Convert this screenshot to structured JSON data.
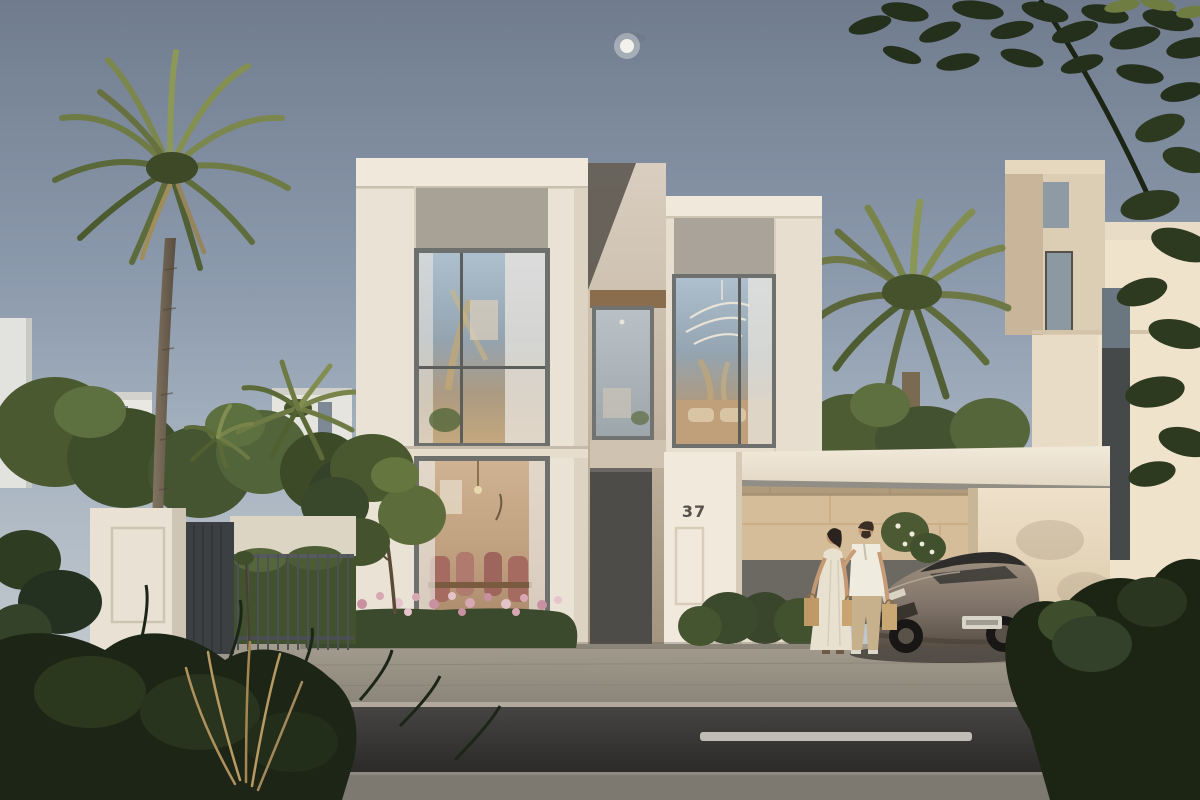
{
  "scene": {
    "title": "Modern villa exterior rendering at dusk",
    "description": "Photorealistic render of a two-storey cream villa with a carport canopy, a bronze sports car, a couple carrying shopping bags, date palms, hedges with pink flowers, a boundary wall with metal gate, and a street in the foreground",
    "house_number": "37",
    "time_of_day": "dusk",
    "objects": [
      "main villa",
      "carport canopy",
      "sports car",
      "couple with shopping bags",
      "date palms",
      "flower bed hedge",
      "boundary wall and gate",
      "street with dashed lane markings",
      "neighbouring villas",
      "moon"
    ]
  },
  "colors": {
    "sky_top": "#707c8e",
    "sky_horizon": "#cfd2d2",
    "moon": "#f2f1ec",
    "facade": "#eae2d4",
    "facade_light": "#f0e9db",
    "panel_gray": "#a7a196",
    "stone": "#d6bd99",
    "wood": "#8a6d4c",
    "door": "#4e4c48",
    "canopy": "#eee6d7",
    "road": "#3c3b3a",
    "sidewalk": "#948d81",
    "hedge": "#3b4a2c",
    "palm": "#6b7742",
    "foliage_dark": "#1d2616",
    "flowers": "#d8a8b2",
    "car_body": "#9a8b7c",
    "dress": "#e9e1d0",
    "shirt": "#f0ebdf",
    "trousers": "#c7b18c"
  }
}
